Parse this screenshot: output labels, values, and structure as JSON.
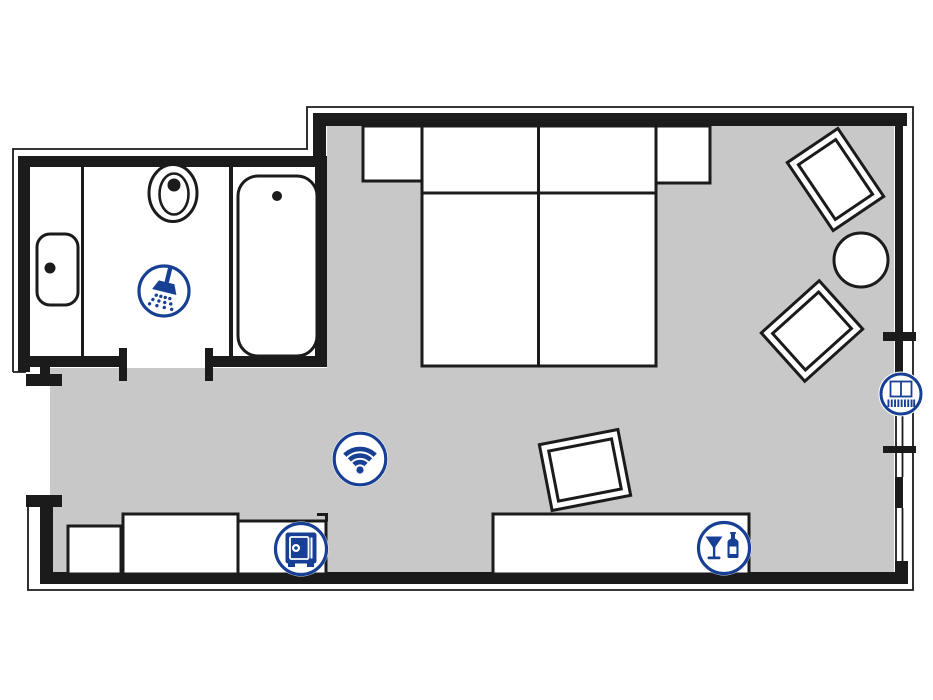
{
  "plan": {
    "title": "hotel-room-floor-plan",
    "colors": {
      "background": "#ffffff",
      "floor": "#c8c8c8",
      "wall": "#1b1b1b",
      "accent": "#173f94"
    },
    "icons": [
      {
        "name": "shower-icon",
        "label": "Shower"
      },
      {
        "name": "wifi-icon",
        "label": "WiFi"
      },
      {
        "name": "safe-icon",
        "label": "Safe"
      },
      {
        "name": "minibar-icon",
        "label": "Minibar"
      },
      {
        "name": "french-balcony-icon",
        "label": "French balcony window"
      }
    ],
    "rooms": [
      {
        "name": "bathroom",
        "features": [
          "washbasin",
          "toilet",
          "shower",
          "bathtub",
          "vanity-counter",
          "door"
        ]
      },
      {
        "name": "bedroom-living",
        "features": [
          "double-bed",
          "nightstand-left",
          "nightstand-right",
          "armchair-top",
          "armchair-bottom",
          "round-table",
          "lounge-chair",
          "bench",
          "cabinet",
          "safe-cabinet",
          "sideboard-minibar",
          "entry-door",
          "windows"
        ]
      }
    ]
  }
}
